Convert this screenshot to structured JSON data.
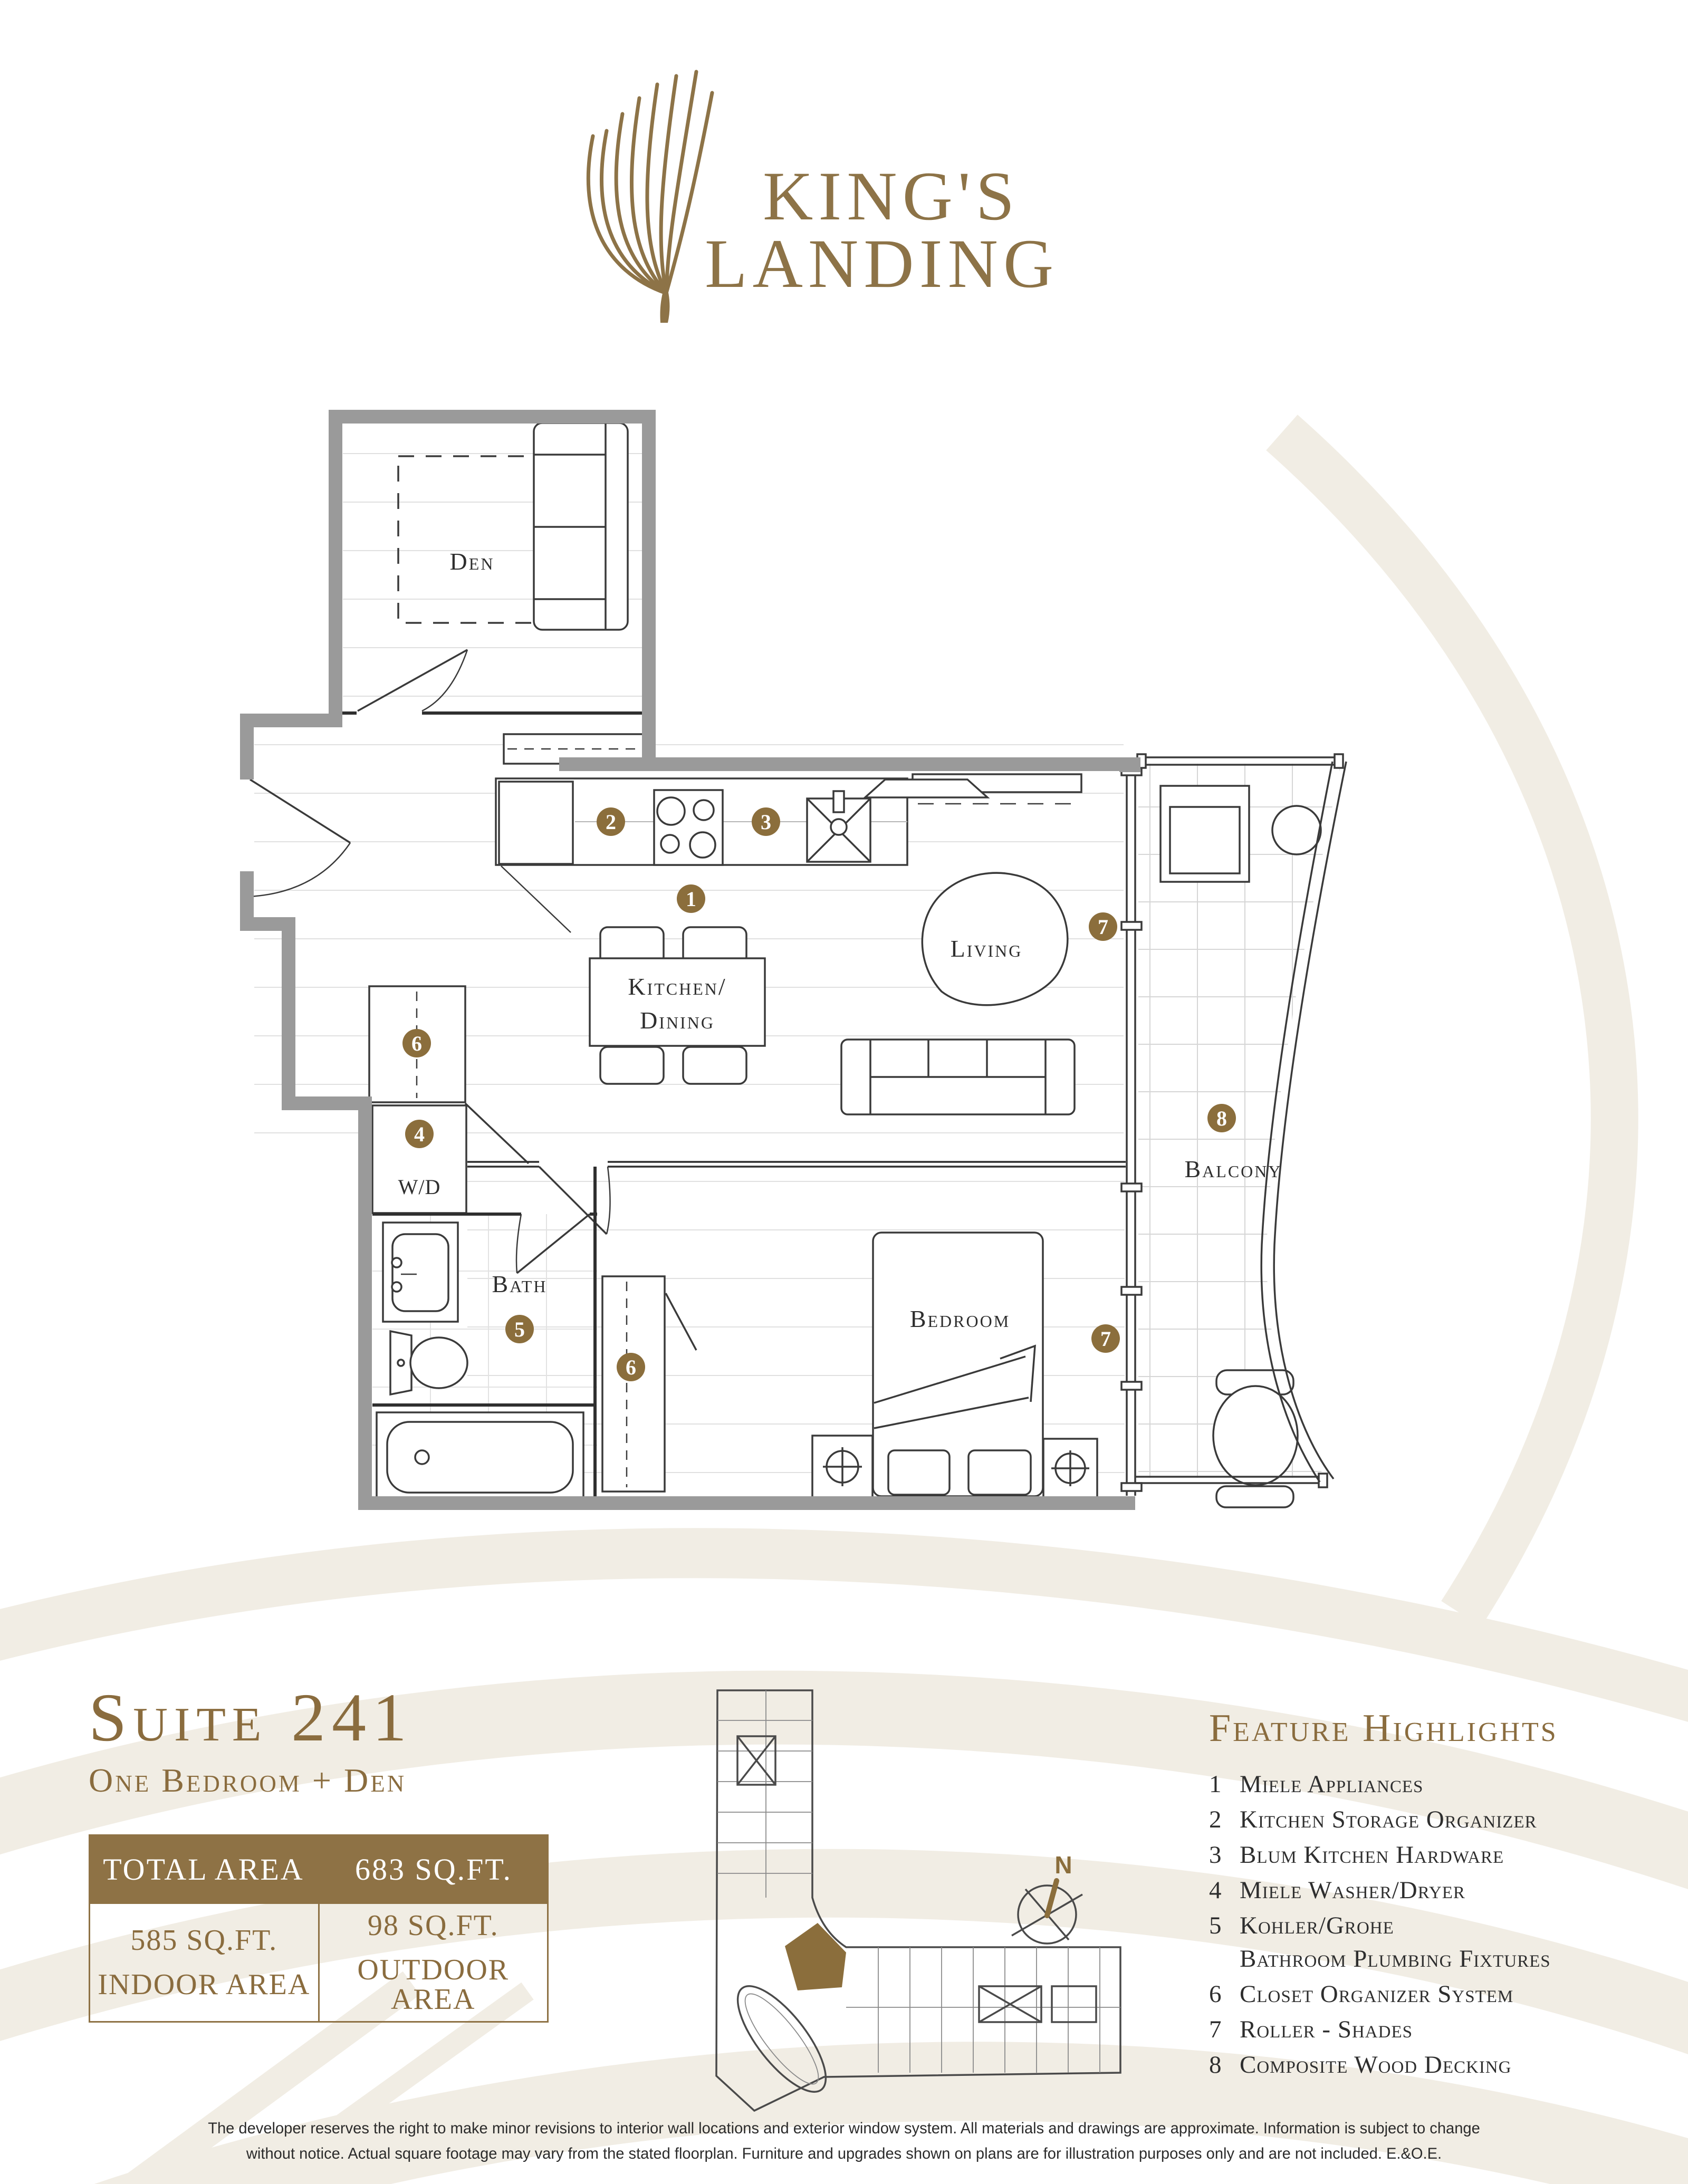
{
  "colors": {
    "gold": "#8b6e3c",
    "gold_text": "#8a6c3e",
    "table_header_bg": "#8e7245",
    "wall_gray": "#9a9a9a",
    "line_dark": "#3a3a3a",
    "wave_cream": "#f1ede4"
  },
  "logo": {
    "icon": "feather-frond-icon",
    "name_line1": "KING'S",
    "name_line2": "LANDING"
  },
  "floorplan": {
    "rooms": {
      "den": "Den",
      "kitchen_line1": "Kitchen/",
      "kitchen_line2": "Dining",
      "living": "Living",
      "bedroom": "Bedroom",
      "bath": "Bath",
      "washer_dryer": "W/D",
      "balcony": "Balcony"
    },
    "markers": {
      "m1": "1",
      "m2": "2",
      "m3": "3",
      "m4": "4",
      "m5": "5",
      "m6_closet": "6",
      "m6_bedroom": "6",
      "m7_living": "7",
      "m7_bedroom": "7",
      "m8": "8"
    }
  },
  "suite": {
    "title": "Suite 241",
    "subtitle": "One Bedroom + Den",
    "area_table": {
      "header_label": "TOTAL AREA",
      "header_value": "683 SQ.FT.",
      "indoor_value": "585 SQ.FT.",
      "indoor_label": "INDOOR AREA",
      "outdoor_value": "98 SQ.FT.",
      "outdoor_label": "OUTDOOR AREA"
    }
  },
  "keyplan": {
    "north_label": "N"
  },
  "features": {
    "title": "Feature Highlights",
    "items": [
      {
        "num": "1",
        "label": "Miele Appliances"
      },
      {
        "num": "2",
        "label": "Kitchen Storage Organizer"
      },
      {
        "num": "3",
        "label": "Blum Kitchen Hardware"
      },
      {
        "num": "4",
        "label": "Miele Washer/Dryer"
      },
      {
        "num": "5",
        "label": "Kohler/Grohe",
        "label_line2": "Bathroom Plumbing Fixtures"
      },
      {
        "num": "6",
        "label": "Closet Organizer System"
      },
      {
        "num": "7",
        "label": "Roller - Shades"
      },
      {
        "num": "8",
        "label": "Composite Wood Decking"
      }
    ]
  },
  "disclaimer": {
    "line1": "The developer reserves the right to make minor revisions to interior wall locations and exterior window system. All materials and drawings are approximate. Information is subject to change",
    "line2": "without notice. Actual square footage may vary from the stated floorplan. Furniture and upgrades shown on plans are for illustration purposes only and are not included. E.&O.E."
  }
}
